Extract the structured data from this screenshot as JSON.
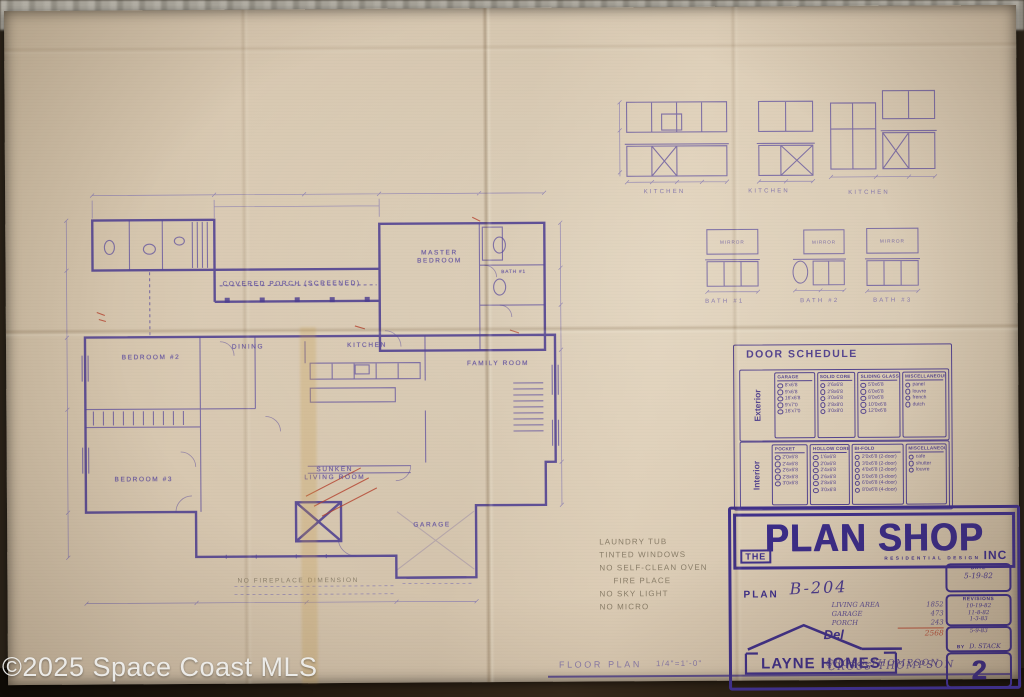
{
  "watermark": "©2025 Space Coast MLS",
  "plan": {
    "rooms": {
      "porch": "COVERED PORCH (SCREENED)",
      "master1": "MASTER",
      "master2": "BEDROOM",
      "bath1": "BATH #1",
      "bedroom2": "BEDROOM #2",
      "bedroom3": "BEDROOM #3",
      "dining": "DINING",
      "kitchen": "KITCHEN",
      "family": "FAMILY ROOM",
      "living1": "SUNKEN",
      "living2": "LIVING ROOM",
      "garage": "GARAGE"
    },
    "pencil_note_fireplace": "NO FIREPLACE DIMENSION",
    "site_notes": [
      "LAUNDRY TUB",
      "TINTED WINDOWS",
      "NO SELF-CLEAN OVEN",
      "FIRE PLACE",
      "NO SKY LIGHT",
      "NO MICRO"
    ]
  },
  "kitchen_elevations": {
    "labels": [
      "KITCHEN",
      "KITCHEN",
      "KITCHEN"
    ]
  },
  "bath_elevations": {
    "labels": [
      "BATH #1",
      "BATH #2",
      "BATH #3"
    ],
    "mirror": "MIRROR"
  },
  "door_schedule": {
    "title": "DOOR SCHEDULE",
    "exterior_label": "Exterior",
    "interior_label": "Interior",
    "exterior": [
      {
        "header": "GARAGE",
        "items": [
          "8'x6'8",
          "9'x6'8",
          "16'x6'8",
          "9'x7'0",
          "16'x7'0"
        ]
      },
      {
        "header": "SOLID CORE",
        "items": [
          "2'6x6'8",
          "2'8x6'8",
          "3'0x6'8",
          "2'8x8'0",
          "3'0x8'0"
        ]
      },
      {
        "header": "SLIDING GLASS",
        "items": [
          "5'0x6'8",
          "6'0x6'8",
          "8'0x6'8",
          "10'0x6'8",
          "12'0x6'8"
        ]
      },
      {
        "header": "MISCELLANEOUS",
        "items": [
          "panel",
          "louvre",
          "french",
          "dutch"
        ]
      }
    ],
    "interior": [
      {
        "header": "POCKET",
        "items": [
          "2'0x6'8",
          "2'4x6'8",
          "2'6x6'8",
          "2'8x6'8",
          "3'0x6'8"
        ]
      },
      {
        "header": "HOLLOW CORE",
        "items": [
          "1'6x6'8",
          "2'0x6'8",
          "2'4x6'8",
          "2'6x6'8",
          "2'8x6'8",
          "3'0x6'8"
        ]
      },
      {
        "header": "BI-FOLD",
        "items": [
          "2'0x6'8 (2-door)",
          "3'0x6'8 (2-door)",
          "4'0x6'8 (2-door)",
          "5'0x6'8 (3-door)",
          "6'0x6'8 (4-door)",
          "8'0x6'8 (4-door)"
        ]
      },
      {
        "header": "MISCELLANEOUS",
        "items": [
          "cafe",
          "shutter",
          "louvre"
        ]
      }
    ]
  },
  "title_block": {
    "the": "THE",
    "brand": "PLAN SHOP",
    "inc": "INC",
    "tagline": "RESIDENTIAL DESIGN",
    "plan_label": "PLAN",
    "plan_number": "B-204",
    "areas": [
      {
        "name": "LIVING AREA",
        "value": "1852"
      },
      {
        "name": "GARAGE",
        "value": "473"
      },
      {
        "name": "PORCH",
        "value": "243"
      }
    ],
    "area_total": "2568",
    "builder_prefix": "Del",
    "builder": "LAYNE HOMES",
    "client": "CROSS-THOMPSON",
    "date_label": "DATE",
    "date": "5-19-82",
    "revisions_label": "REVISIONS",
    "revisions": [
      "10-19-82",
      "11-8-82",
      "1-3-83"
    ],
    "by_label": "BY",
    "by_date": "5-9-83",
    "by": "D. STACK",
    "sheet_number": "2"
  },
  "footer": {
    "drawing_title": "FLOOR PLAN",
    "scale": "1/4\"=1'-0\""
  }
}
